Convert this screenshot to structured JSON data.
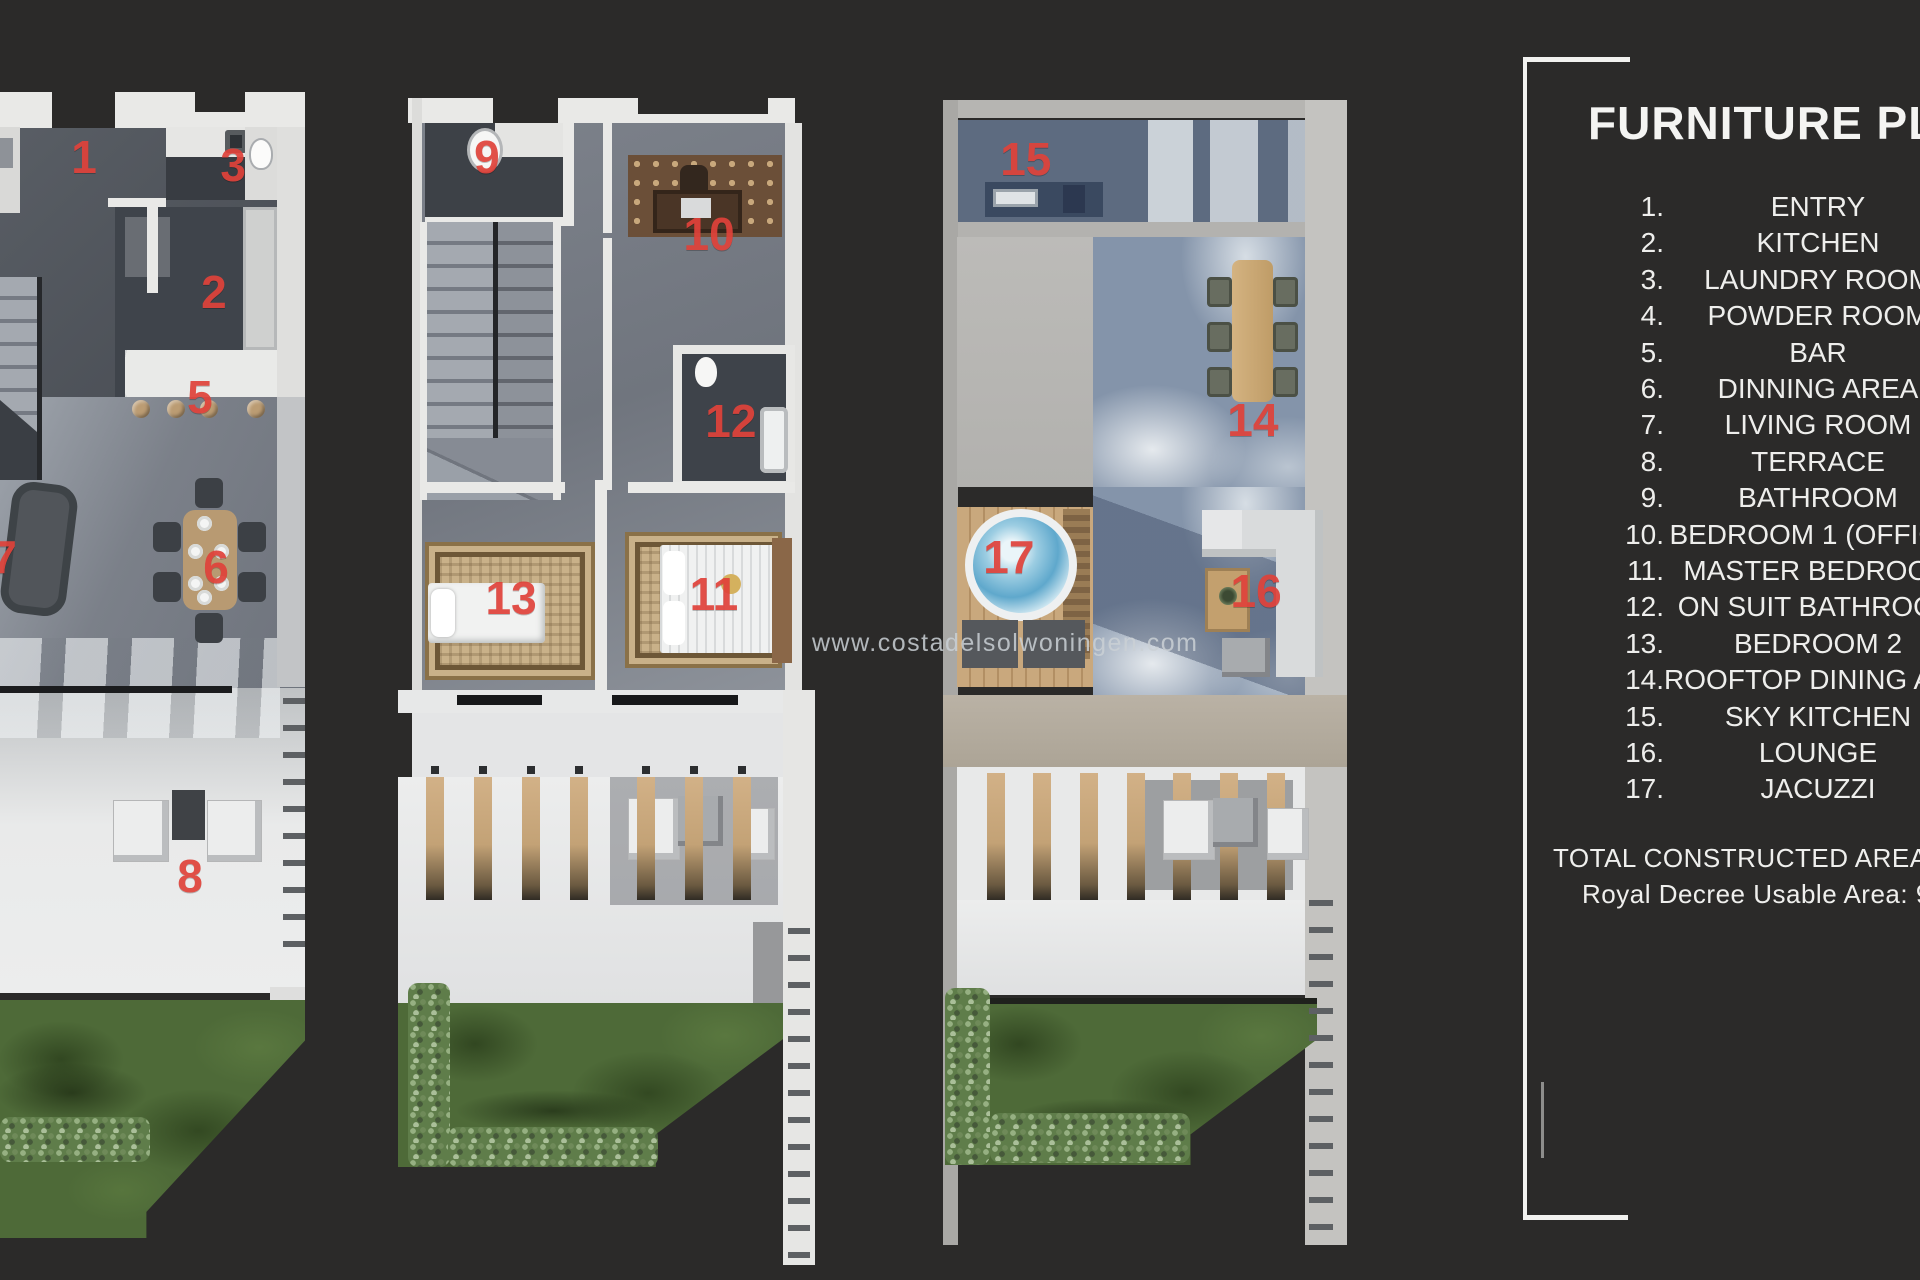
{
  "watermark": "www.costadelsolwoningen.com",
  "legend": {
    "title": "FURNITURE PLAN",
    "items": [
      {
        "num": "1.",
        "label": "ENTRY"
      },
      {
        "num": "2.",
        "label": "KITCHEN"
      },
      {
        "num": "3.",
        "label": "LAUNDRY ROOM"
      },
      {
        "num": "4.",
        "label": "POWDER ROOM"
      },
      {
        "num": "5.",
        "label": "BAR"
      },
      {
        "num": "6.",
        "label": "DINNING AREA"
      },
      {
        "num": "7.",
        "label": "LIVING ROOM"
      },
      {
        "num": "8.",
        "label": "TERRACE"
      },
      {
        "num": "9.",
        "label": "BATHROOM"
      },
      {
        "num": "10.",
        "label": "BEDROOM 1 (OFFICE)"
      },
      {
        "num": "11.",
        "label": "MASTER BEDROOM"
      },
      {
        "num": "12.",
        "label": "ON SUIT BATHROOM"
      },
      {
        "num": "13.",
        "label": "BEDROOM 2"
      },
      {
        "num": "14.",
        "label": "ROOFTOP DINING AREA"
      },
      {
        "num": "15.",
        "label": "SKY KITCHEN"
      },
      {
        "num": "16.",
        "label": "LOUNGE"
      },
      {
        "num": "17.",
        "label": "JACUZZI"
      }
    ],
    "total_constructed": "TOTAL CONSTRUCTED AREA: 1",
    "usable_area": "Royal Decree Usable Area: 9"
  },
  "colors": {
    "background": "#2b2a29",
    "marker_red": "#e0423a",
    "legend_text": "#eeeeec",
    "wall_white": "#e9e9e7",
    "grass_green": "#4e6a38",
    "rooftop_blue": "#8494aa",
    "wood_tan": "#c9a87d",
    "watermark_gray": "#cad0d5"
  },
  "plans": [
    {
      "name": "ground-floor",
      "markers": [
        {
          "n": "1",
          "x": 27.1,
          "y": 7.1
        },
        {
          "n": "3",
          "x": 75.2,
          "y": 7.8
        },
        {
          "n": "2",
          "x": 69.0,
          "y": 19.2
        },
        {
          "n": "5",
          "x": 64.5,
          "y": 28.6
        },
        {
          "n": "7",
          "x": 1.3,
          "y": 42.9
        },
        {
          "n": "6",
          "x": 69.7,
          "y": 43.8
        },
        {
          "n": "8",
          "x": 61.3,
          "y": 71.4
        }
      ]
    },
    {
      "name": "first-floor",
      "markers": [
        {
          "n": "9",
          "x": 22.0,
          "y": 6.6
        },
        {
          "n": "10",
          "x": 77.0,
          "y": 13.0
        },
        {
          "n": "12",
          "x": 82.4,
          "y": 28.5
        },
        {
          "n": "13",
          "x": 28.0,
          "y": 43.3
        },
        {
          "n": "11",
          "x": 78.2,
          "y": 42.9
        }
      ]
    },
    {
      "name": "rooftop",
      "markers": [
        {
          "n": "15",
          "x": 20.5,
          "y": 5.6
        },
        {
          "n": "14",
          "x": 76.7,
          "y": 28.3
        },
        {
          "n": "17",
          "x": 16.3,
          "y": 40.2
        },
        {
          "n": "16",
          "x": 77.5,
          "y": 43.1
        }
      ]
    }
  ]
}
